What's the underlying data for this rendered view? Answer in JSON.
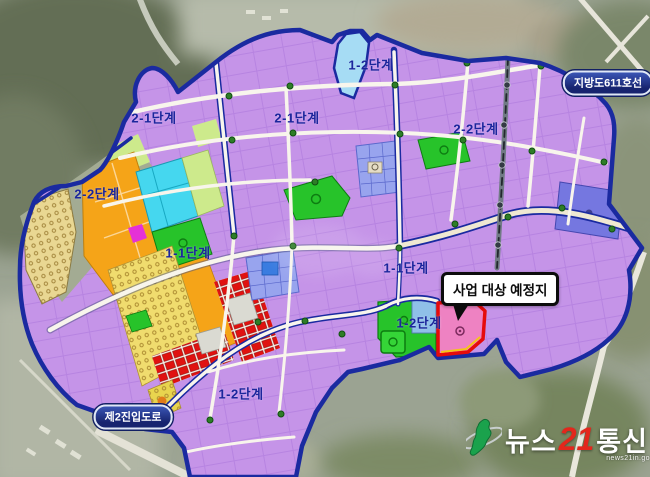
{
  "map": {
    "phase_labels": [
      {
        "name": "phase-1-2-top",
        "text": "1-2단계"
      },
      {
        "name": "phase-2-1-left",
        "text": "2-1단계"
      },
      {
        "name": "phase-2-1-center",
        "text": "2-1단계"
      },
      {
        "name": "phase-2-2-right",
        "text": "2-2단계"
      },
      {
        "name": "phase-2-2-left",
        "text": "2-2단계"
      },
      {
        "name": "phase-1-1-left",
        "text": "1-1단계"
      },
      {
        "name": "phase-1-1-right",
        "text": "1-1단계"
      },
      {
        "name": "phase-1-2-right",
        "text": "1-2단계"
      },
      {
        "name": "phase-1-2-bottom",
        "text": "1-2단계"
      }
    ],
    "road_labels": {
      "provincial_road": "지방도611호선",
      "access_road": "제2진입도로"
    },
    "callout": {
      "text": "사업 대상 예정지"
    },
    "colors": {
      "boundary_navy": "#1a2aa0",
      "parcel_purple": "#c594e8",
      "zone_orange": "#f5a418",
      "zone_green": "#27c32a",
      "zone_cyan": "#45d7ef",
      "zone_red": "#e3100e",
      "site_pink": "#ee82c2",
      "site_border_red": "#e60b0b",
      "zone_periwinkle": "#98a4ee",
      "zone_blue_violet": "#7577e0",
      "zone_light_green": "#cdea8c",
      "zone_residential_yellow": "#f0dc6e",
      "road_pill_navy": "#17246f"
    }
  },
  "watermark": {
    "part1": "뉴스",
    "number": "21",
    "part2": "통신",
    "subtext": "news21in.go"
  }
}
